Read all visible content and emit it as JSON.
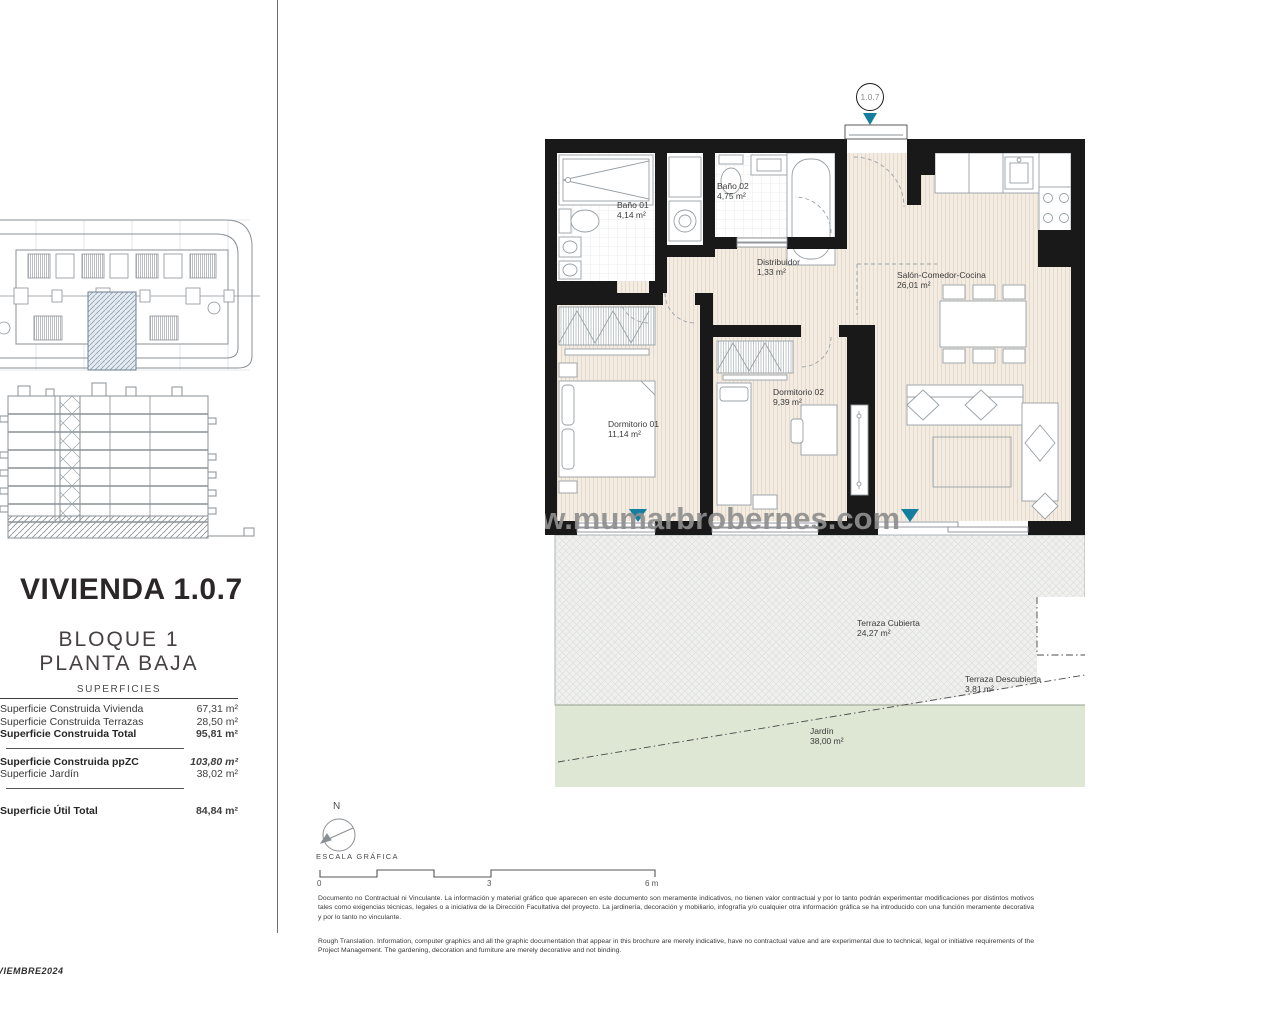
{
  "title_block": {
    "title": "VIVIENDA 1.0.7",
    "block": "BLOQUE 1",
    "floor": "PLANTA BAJA",
    "table_title": "SUPERFICIES",
    "rows": [
      {
        "label": "Superficie Construida Vivienda",
        "value": "67,31 m²"
      },
      {
        "label": "Superficie Construida Terrazas",
        "value": "28,50 m²"
      },
      {
        "label": "Superficie Construida Total",
        "value": "95,81 m²"
      },
      {
        "label": "Superficie Construida ppZC",
        "value": "103,80 m²"
      },
      {
        "label": "Superficie Jardín",
        "value": "38,02 m²"
      },
      {
        "label": "Superficie Útil Total",
        "value": "84,84 m²"
      }
    ]
  },
  "plan": {
    "unit_marker": "1.0.7",
    "watermark": "www.mumarbrobernes.com",
    "rooms": [
      {
        "name": "Baño 01",
        "area": "4,14 m²"
      },
      {
        "name": "Baño 02",
        "area": "4,75 m²"
      },
      {
        "name": "Distribuidor",
        "area": "1,33 m²"
      },
      {
        "name": "Salón-Comedor-Cocina",
        "area": "26,01 m²"
      },
      {
        "name": "Dormitorio 01",
        "area": "11,14 m²"
      },
      {
        "name": "Dormitorio 02",
        "area": "9,39 m²"
      },
      {
        "name": "Terraza Cubierta",
        "area": "24,27 m²"
      },
      {
        "name": "Terraza Descubierta",
        "area": "3,81 m²"
      },
      {
        "name": "Jardín",
        "area": "38,00 m²"
      }
    ]
  },
  "scale_block": {
    "north": "N",
    "caption": "ESCALA GRÁFICA",
    "ticks": [
      "0",
      "3",
      "6 m"
    ]
  },
  "footer": {
    "stamp": "VIEMBRE2024",
    "spanish": "Documento no Contractual ni Vinculante. La información y material gráfico que aparecen en este documento son meramente indicativos, no tienen valor contractual y por lo tanto podrán experimentar modificaciones por distintos motivos tales como exigencias técnicas, legales o a iniciativa de la Dirección Facultativa del proyecto. La jardinería, decoración y mobiliario, infografía y/o cualquier otra información gráfica se ha introducido con una función meramente decorativa y por lo tanto no vinculante.",
    "english": "Rough Translation. Information, computer graphics and all the graphic documentation that appear in this brochure are merely indicative, have no contractual value and are experimental due to technical, legal or initiative requirements of the Project Management. The gardening, decoration and furniture are merely decorative and not binding."
  },
  "colors": {
    "wall": "#191919",
    "floor_beige": "#f3ece3",
    "terrace": "#f0f1ef",
    "garden": "#dde7d3",
    "marker_teal": "#147e9e",
    "line_grey": "#98a0a6"
  }
}
